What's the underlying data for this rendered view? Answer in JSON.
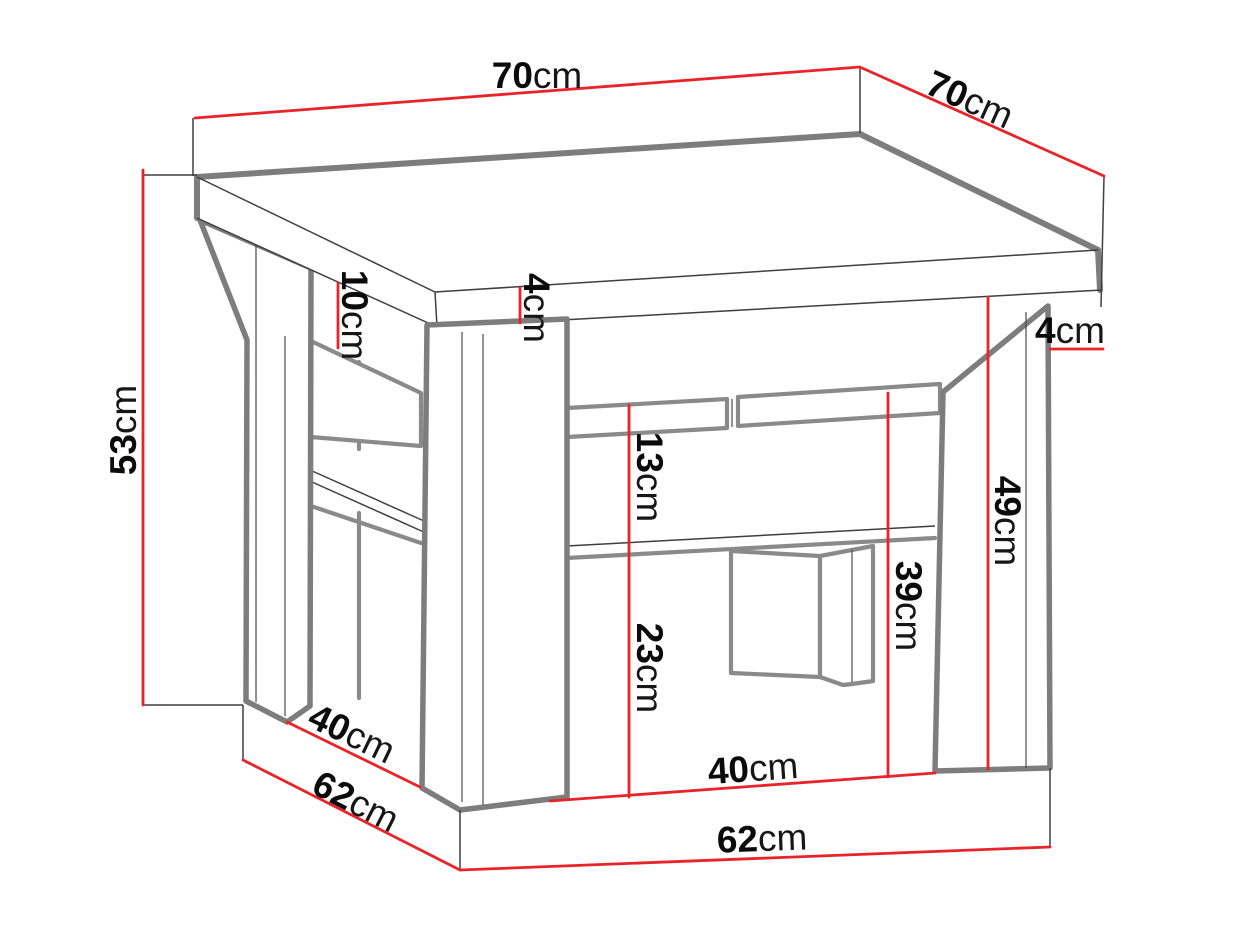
{
  "diagram": {
    "type": "furniture-dimension-drawing",
    "subject": "coffee table with lower shelf and cross base",
    "unit": "cm",
    "colors": {
      "background": "#ffffff",
      "dimension_line": "#e8242a",
      "outline_thick": "#7d7d7d",
      "outline_thin": "#3f3f3f",
      "label_text": "#0b0b0b"
    },
    "labels": {
      "top_width": {
        "value": "70",
        "unit": "cm"
      },
      "top_depth": {
        "value": "70",
        "unit": "cm"
      },
      "total_height": {
        "value": "53",
        "unit": "cm"
      },
      "apron_height": {
        "value": "10",
        "unit": "cm"
      },
      "top_thickness": {
        "value": "4",
        "unit": "cm"
      },
      "side_overhang": {
        "value": "4",
        "unit": "cm"
      },
      "shelf_gap": {
        "value": "13",
        "unit": "cm"
      },
      "under_shelf": {
        "value": "23",
        "unit": "cm"
      },
      "shelf_height": {
        "value": "39",
        "unit": "cm"
      },
      "under_top": {
        "value": "49",
        "unit": "cm"
      },
      "leg_span_left": {
        "value": "40",
        "unit": "cm"
      },
      "base_depth": {
        "value": "62",
        "unit": "cm"
      },
      "leg_span_front": {
        "value": "40",
        "unit": "cm"
      },
      "base_width": {
        "value": "62",
        "unit": "cm"
      }
    }
  }
}
